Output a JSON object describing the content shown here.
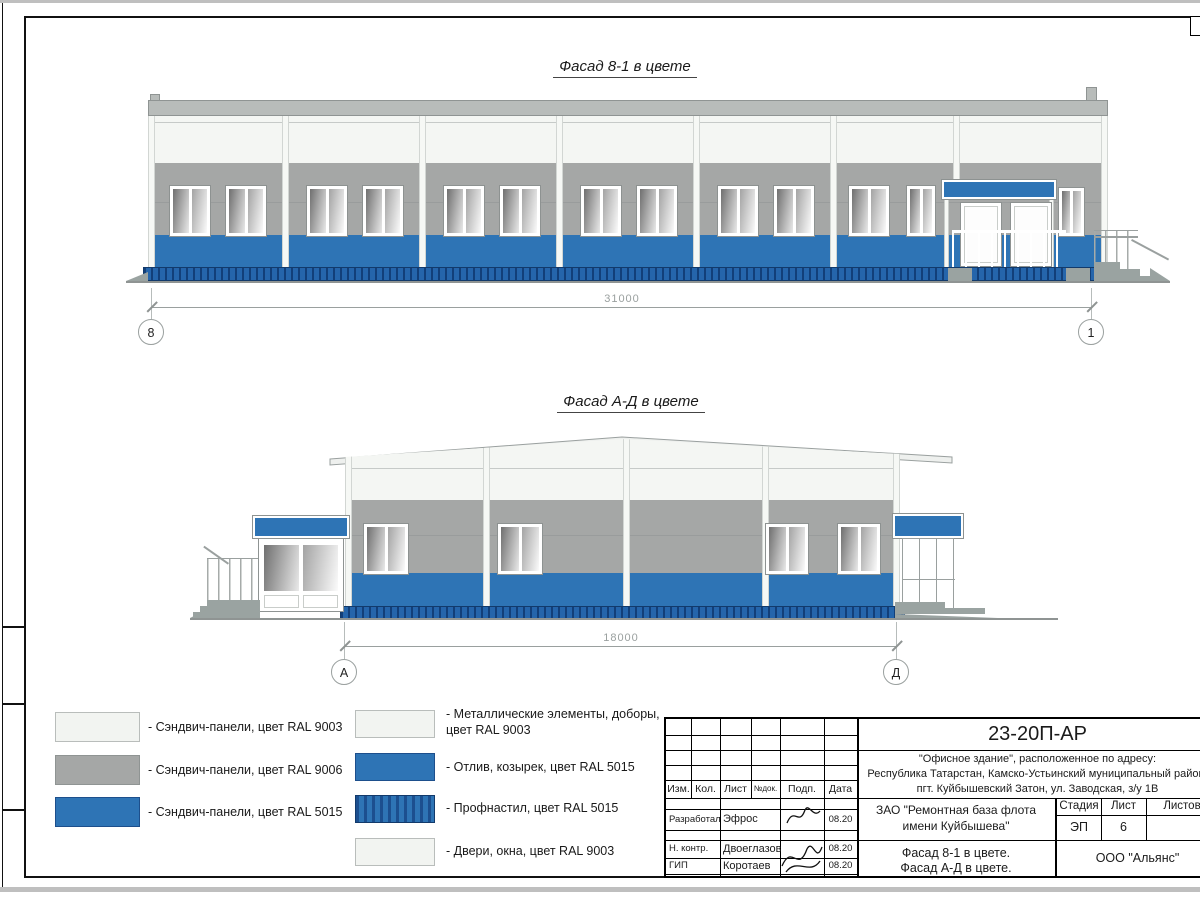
{
  "facade1": {
    "title": "Фасад 8-1 в цвете",
    "dimension": "31000",
    "axis_left": "8",
    "axis_right": "1"
  },
  "facade2": {
    "title": "Фасад А-Д в цвете",
    "dimension": "18000",
    "axis_left": "А",
    "axis_right": "Д"
  },
  "legend": {
    "left": [
      {
        "label": "- Сэндвич-панели, цвет RAL 9003",
        "color": "#f2f4f1"
      },
      {
        "label": "- Сэндвич-панели, цвет RAL 9006",
        "color": "#a5a7a6"
      },
      {
        "label": "- Сэндвич-панели, цвет RAL 5015",
        "color": "#2e74b5"
      }
    ],
    "right": [
      {
        "label": "- Металлические элементы, доборы, цвет RAL 9003",
        "color": "#f2f4f1"
      },
      {
        "label": "- Отлив, козырек, цвет RAL 5015",
        "color": "#2e74b5"
      },
      {
        "label": "- Профнастил, цвет RAL 5015",
        "color": "#2e74b5",
        "pattern": "striped"
      },
      {
        "label": "- Двери, окна, цвет RAL 9003",
        "color": "#f2f4f1"
      }
    ]
  },
  "titleblock": {
    "doc_code": "23-20П-АР",
    "address_line1": "\"Офисное здание\", расположенное по адресу:",
    "address_line2": "Республика Татарстан, Камско-Устьинский муниципальный район,",
    "address_line3": "пгт. Куйбышевский Затон, ул. Заводская, з/у 1В",
    "header": {
      "izm": "Изм.",
      "kol": "Кол.",
      "list": "Лист",
      "ndok": "№док.",
      "podp": "Подп.",
      "data": "Дата"
    },
    "rows": [
      {
        "role": "Разработал",
        "name": "Эфрос",
        "date": "08.20"
      },
      {
        "role": "Н. контр.",
        "name": "Двоеглазов",
        "date": "08.20"
      },
      {
        "role": "ГИП",
        "name": "Коротаев",
        "date": "08.20"
      }
    ],
    "client_line1": "ЗАО \"Ремонтная база флота",
    "client_line2": "имени Куйбышева\"",
    "stage_label": "Стадия",
    "sheet_label": "Лист",
    "sheets_label": "Листов",
    "stage": "ЭП",
    "sheet_no": "6",
    "doc_title_line1": "Фасад 8-1 в цвете.",
    "doc_title_line2": "Фасад А-Д в цвете.",
    "company": "ООО \"Альянс\""
  },
  "colors": {
    "ral9003": "#f2f4f1",
    "ral9006": "#a5a7a6",
    "ral5015": "#2e74b5",
    "profnastil_dark": "#123f79"
  }
}
